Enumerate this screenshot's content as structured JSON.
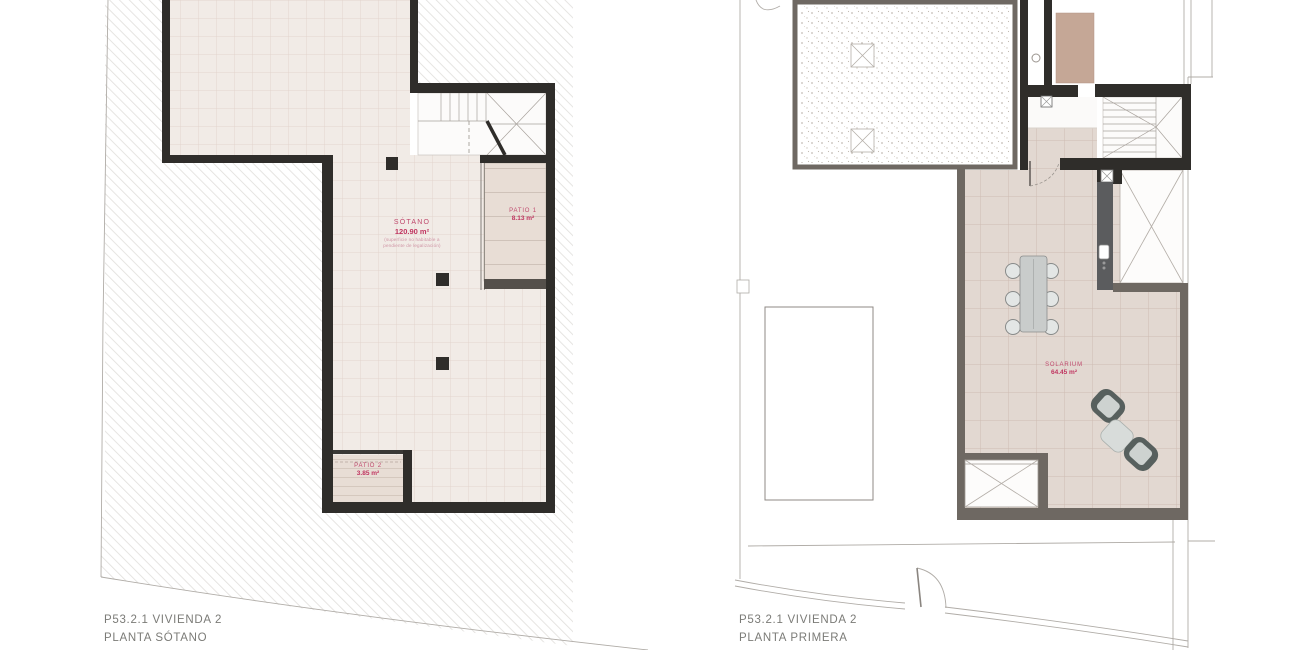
{
  "colors": {
    "accent_pink": "#c04a6e",
    "label_gray": "#7b7b77",
    "wall_black": "#2f2d2a",
    "wall_gray": "#6e6862",
    "floor_beige": "#f1ebe6",
    "floor_solarium": "#e2d8d1",
    "patio_tan": "#e8ddd5"
  },
  "plans": {
    "sotano": {
      "footer_line1": "P53.2.1 VIVIENDA 2",
      "footer_line2": "PLANTA SÓTANO",
      "rooms": {
        "sotano": {
          "name": "SÓTANO",
          "area": "120.90 m²",
          "note_line1": "(superficie no habitable a",
          "note_line2": "pendiente de legalización)"
        },
        "patio1": {
          "name": "PATIO 1",
          "area": "8.13 m²"
        },
        "patio2": {
          "name": "PATIO 2",
          "area": "3.85 m²"
        }
      }
    },
    "primera": {
      "footer_line1": "P53.2.1 VIVIENDA 2",
      "footer_line2": "PLANTA PRIMERA",
      "rooms": {
        "solarium": {
          "name": "SOLARIUM",
          "area": "64.45 m²"
        }
      }
    }
  }
}
